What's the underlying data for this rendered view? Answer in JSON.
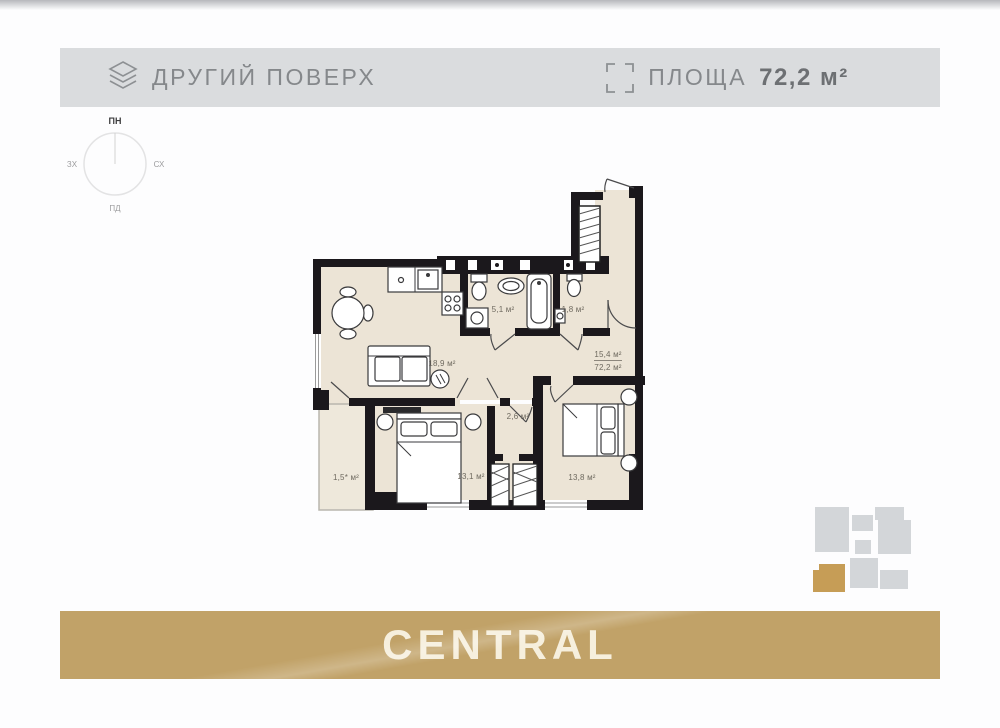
{
  "header": {
    "floor_label": "ДРУГИЙ ПОВЕРХ",
    "area_label": "ПЛОЩА",
    "area_value": "72,2 м²",
    "icons": [
      "layers-icon",
      "area-frame-icon"
    ]
  },
  "compass": {
    "north": "ПН",
    "east": "СХ",
    "south": "ПД",
    "west": "ЗХ"
  },
  "floor_plan": {
    "rooms": [
      {
        "name": "living-kitchen",
        "area": "18,9 м²"
      },
      {
        "name": "bathroom",
        "area": "5,1 м²"
      },
      {
        "name": "wc",
        "area": "1,8 м²"
      },
      {
        "name": "hall",
        "area": "15,4 м²",
        "total_area": "72,2 м²"
      },
      {
        "name": "closet",
        "area": "2,6 м²"
      },
      {
        "name": "balcony",
        "area": "1,5* м²"
      },
      {
        "name": "bedroom-1",
        "area": "13,1 м²"
      },
      {
        "name": "bedroom-2",
        "area": "13,8 м²"
      }
    ]
  },
  "footer": {
    "brand": "CENTRAL"
  },
  "theme": {
    "header_bg": "#dadcde",
    "header_text": "#85888b",
    "header_text_bold": "#6d7073",
    "floor": "#ece4d6",
    "wall": "#1b181c",
    "label_color": "#6e695f",
    "mini_block": "#d3d6d9",
    "mini_gold": "#c69d56",
    "banner_bg": "#c1a268",
    "banner_text": "#f6efdd"
  }
}
